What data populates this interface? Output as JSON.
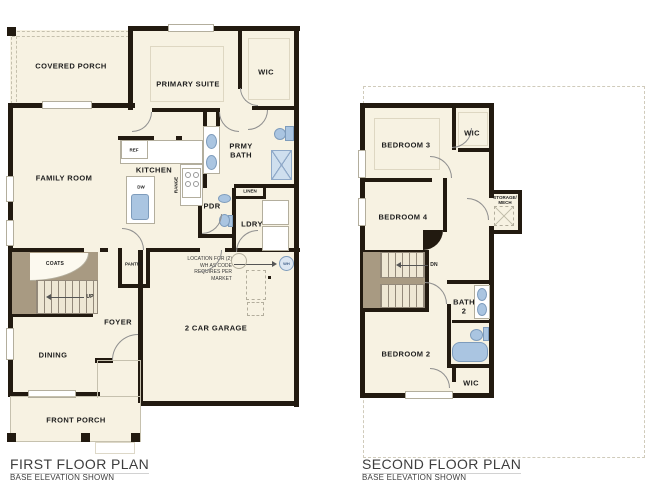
{
  "document": {
    "type": "residential floor plan drawing",
    "background": "#ffffff"
  },
  "colors": {
    "wall": "#221a10",
    "floor": "#f7f2e2",
    "stair_brown": "#a89a82",
    "fixture_blue": "#aac5e1",
    "label_text": "#1c1c1c",
    "title_text": "#3d3d3d"
  },
  "first_floor": {
    "title": "FIRST FLOOR PLAN",
    "subtitle": "BASE ELEVATION SHOWN",
    "rooms": {
      "covered_porch": "COVERED PORCH",
      "primary_suite": "PRIMARY SUITE",
      "wic": "WIC",
      "family_room": "FAMILY ROOM",
      "kitchen": "KITCHEN",
      "primary_bath": "PRMY BATH",
      "powder": "PDR",
      "laundry": "LDRY",
      "linen": "LINEN",
      "coats": "COATS",
      "pantry": "PANTRY",
      "foyer": "FOYER",
      "dining": "DINING",
      "front_porch": "FRONT PORCH",
      "garage": "2 CAR GARAGE"
    },
    "annotations": {
      "ref": "REF",
      "dw": "DW",
      "range": "RANGE",
      "up": "UP",
      "wh": "WH",
      "wh_note": "LOCATION FOR (2) WH AS CODE REQUIRES PER MARKET"
    }
  },
  "second_floor": {
    "title": "SECOND FLOOR PLAN",
    "subtitle": "BASE ELEVATION SHOWN",
    "rooms": {
      "bedroom_3": "BEDROOM 3",
      "wic_upper": "WIC",
      "bedroom_4": "BEDROOM 4",
      "storage_mech": "STORAGE/ MECH",
      "bath_2": "BATH 2",
      "bedroom_2": "BEDROOM 2",
      "wic_lower": "WIC"
    },
    "annotations": {
      "down": "DN"
    }
  }
}
